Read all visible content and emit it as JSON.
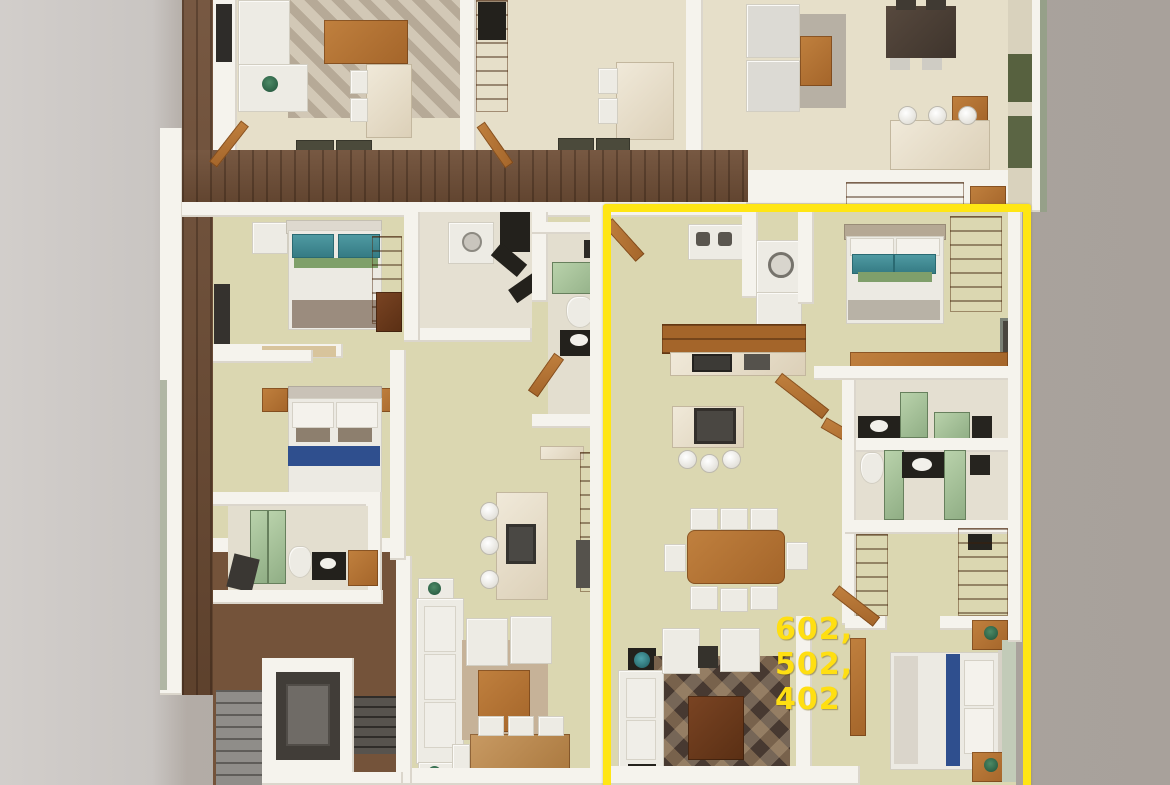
{
  "scene": {
    "type": "3d-floor-plan-top-view",
    "description": "Rendered top-down 3D floor plan of an apartment storey with one unit outlined in yellow"
  },
  "highlight": {
    "label_lines": [
      "602,",
      "502,",
      "402"
    ],
    "units": [
      "602",
      "502",
      "402"
    ],
    "border_color": "#ffe614",
    "label_color": "#ffdf12"
  },
  "palette": {
    "floor_lower_units": "#dbd7b1",
    "floor_upper_units": "#e6dfc9",
    "walls": "#f5f3ed",
    "wood_corridor": "#6d4c34",
    "accent_yellow": "#ffe614"
  }
}
